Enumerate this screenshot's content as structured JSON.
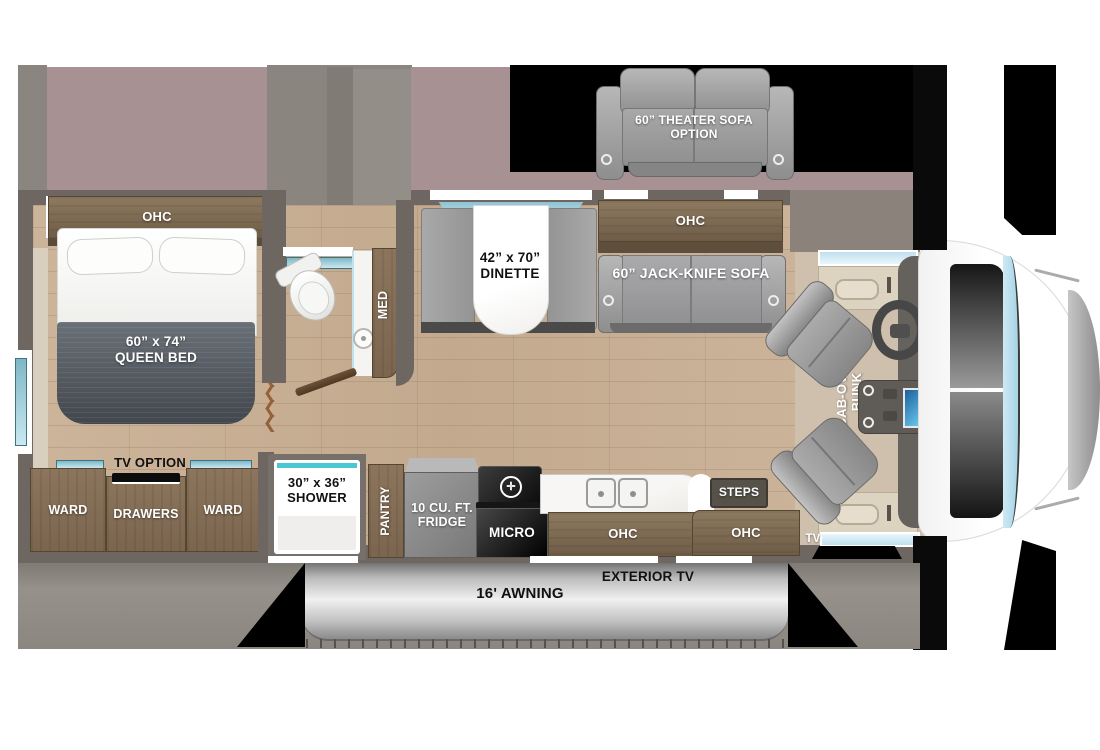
{
  "plan_title": "RV floor plan",
  "slideout": {
    "theater_sofa_line1": "60” THEATER SOFA",
    "theater_sofa_line2": "OPTION"
  },
  "bedroom": {
    "ohc": "OHC",
    "bed_line1": "60” x 74”",
    "bed_line2": "QUEEN BED",
    "tv_option": "TV OPTION",
    "ward_left": "WARD",
    "drawers": "DRAWERS",
    "ward_right": "WARD"
  },
  "bath": {
    "med": "MED",
    "shower_line1": "30” x 36”",
    "shower_line2": "SHOWER"
  },
  "dinette": {
    "line1": "42” x 70”",
    "line2": "DINETTE"
  },
  "living": {
    "ohc": "OHC",
    "sofa": "60” JACK-KNIFE SOFA"
  },
  "kitchen": {
    "pantry": "PANTRY",
    "fridge_line1": "10 CU. FT.",
    "fridge_line2": "FRIDGE",
    "micro": "MICRO",
    "ohc": "OHC"
  },
  "entry": {
    "steps": "STEPS",
    "ohc": "OHC"
  },
  "cab": {
    "bunk_line1": "CAB-OVER",
    "bunk_line2": "BUNK",
    "tv": "TV"
  },
  "exterior": {
    "awning": "16' AWNING",
    "exterior_tv": "EXTERIOR TV"
  },
  "colors": {
    "floor_wood": "#c8b197",
    "cab_floor": "#cfc0ae",
    "wall_dark": "#6e6661",
    "exterior_gray": "#8f8a84",
    "slide_mauve": "#a89192",
    "cabinet_brown": "#82715c",
    "sofa_gray": "#9c9c9e",
    "window_teal": "#8fc6d4",
    "screen_blue": "#2f8fd0",
    "black": "#000000"
  }
}
